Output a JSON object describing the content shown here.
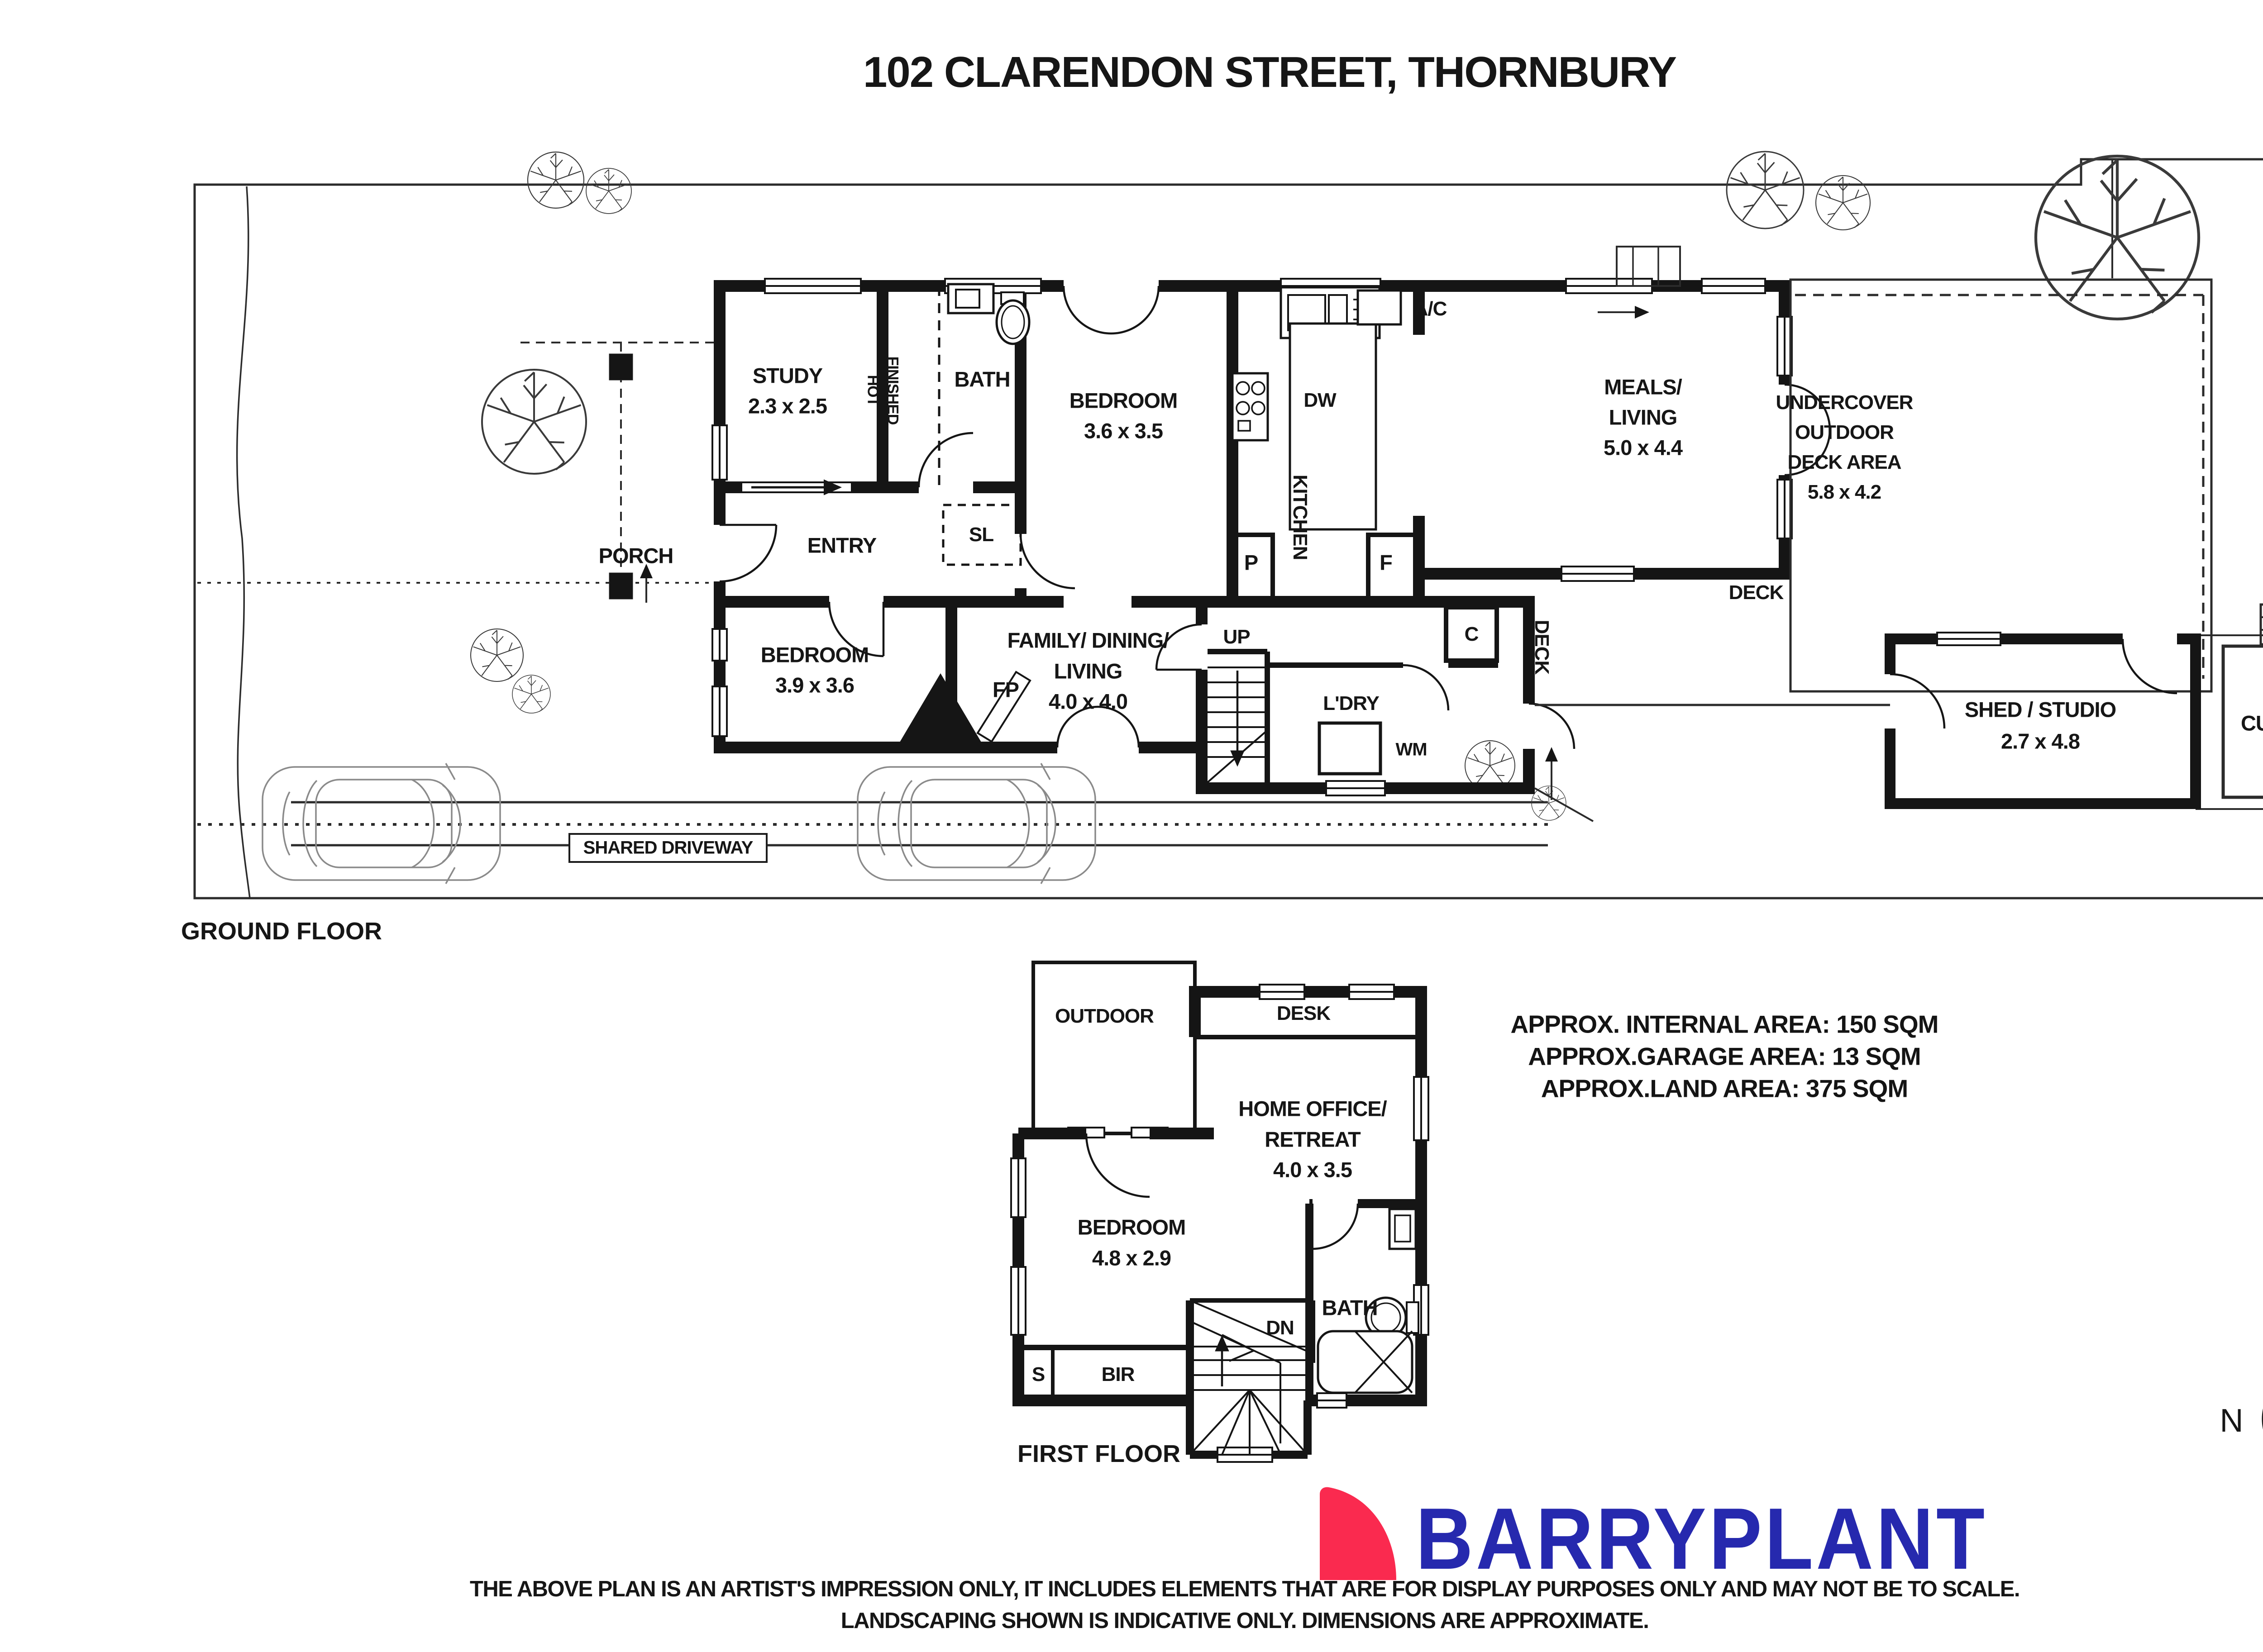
{
  "title": "102 CLARENDON STREET, THORNBURY",
  "ground": {
    "section_label": "GROUND FLOOR",
    "study": {
      "name": "STUDY",
      "dims": "2.3 x 2.5"
    },
    "hot_finished": {
      "line1": "HOT",
      "line2": "FINISHED"
    },
    "bath": {
      "name": "BATH"
    },
    "sl": {
      "label": "SL"
    },
    "entry": {
      "label": "ENTRY"
    },
    "porch": {
      "label": "PORCH"
    },
    "bedroom1": {
      "name": "BEDROOM",
      "dims": "3.6 x 3.5"
    },
    "kitchen": {
      "label": "KITCHEN"
    },
    "dw": {
      "label": "DW"
    },
    "ac": {
      "label": "A/C"
    },
    "p": {
      "label": "P"
    },
    "f": {
      "label": "F"
    },
    "meals": {
      "name1": "MEALS/",
      "name2": "LIVING",
      "dims": "5.0 x 4.4"
    },
    "undercover": {
      "name1": "UNDERCOVER",
      "name2": "OUTDOOR",
      "name3": "DECK AREA",
      "dims": "5.8 x 4.2"
    },
    "up": {
      "label": "UP"
    },
    "c": {
      "label": "C"
    },
    "deck_inner": {
      "label": "DECK"
    },
    "deck_outer": {
      "label": "DECK"
    },
    "ldry": {
      "label": "L'DRY"
    },
    "wm": {
      "label": "WM"
    },
    "fp": {
      "label": "FP"
    },
    "bedroom2": {
      "name": "BEDROOM",
      "dims": "3.9 x 3.6"
    },
    "family": {
      "name1": "FAMILY/ DINING/",
      "name2": "LIVING",
      "dims": "4.0 x 4.0"
    },
    "shed": {
      "name": "SHED / STUDIO",
      "dims": "2.7 x 4.8"
    },
    "cubby": {
      "label": "CUBBY"
    },
    "driveway": {
      "label": "SHARED DRIVEWAY"
    }
  },
  "first": {
    "section_label": "FIRST FLOOR",
    "outdoor": {
      "label": "OUTDOOR"
    },
    "desk": {
      "label": "DESK"
    },
    "home_office": {
      "name1": "HOME OFFICE/",
      "name2": "RETREAT",
      "dims": "4.0 x 3.5"
    },
    "bedroom3": {
      "name": "BEDROOM",
      "dims": "4.8 x 2.9"
    },
    "bath": {
      "name": "BATH"
    },
    "dn": {
      "label": "DN"
    },
    "s": {
      "label": "S"
    },
    "bir": {
      "label": "BIR"
    }
  },
  "areas": {
    "internal": "APPROX. INTERNAL AREA: 150 SQM",
    "garage": "APPROX.GARAGE AREA: 13 SQM",
    "land": "APPROX.LAND AREA: 375 SQM"
  },
  "compass": {
    "north": "N"
  },
  "branding": {
    "name": "BARRYPLANT",
    "blue": "#2629AE",
    "red": "#FA2A4F"
  },
  "disclaimer": {
    "line1": "THE ABOVE PLAN IS AN ARTIST'S IMPRESSION ONLY, IT INCLUDES ELEMENTS THAT ARE FOR DISPLAY PURPOSES ONLY AND MAY NOT BE TO SCALE.",
    "line2": "LANDSCAPING SHOWN IS INDICATIVE ONLY. DIMENSIONS ARE APPROXIMATE."
  }
}
